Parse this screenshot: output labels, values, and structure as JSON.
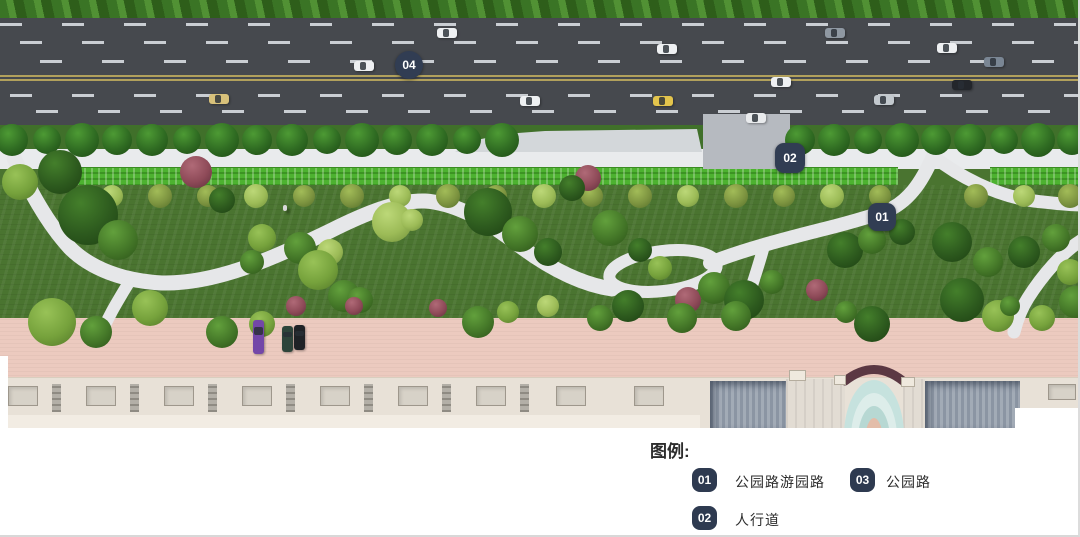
{
  "legend": {
    "title": "图例:",
    "badge_color": "#2e3a50",
    "items": [
      {
        "num": "01",
        "label": "公园路游园路"
      },
      {
        "num": "03",
        "label": "公园路"
      },
      {
        "num": "02",
        "label": "人行道"
      }
    ]
  },
  "markers": [
    {
      "label": "04",
      "meaning": "公园路"
    },
    {
      "label": "02",
      "meaning": "人行道"
    },
    {
      "label": "01",
      "meaning": "公园路游园路"
    }
  ],
  "scene": {
    "marker_bg": "#313d53",
    "road_color": "#46494e",
    "lane_dash_color": "#caced3",
    "center_line_color": "#b2a15c",
    "sidewalk_color": "#e9ebed",
    "hedge_color": "#4db230",
    "grass_color": "#4a7430",
    "path_color": "#e6e7e9",
    "promenade_color": "#eccabf",
    "building_color": "#e8e1d7",
    "pool_colors": [
      "#c6e2de",
      "#ddedea",
      "#b7d8d3",
      "#e3bda9"
    ],
    "tree_types": {
      "dk": {
        "b": "#2d5a1e",
        "l": "#447f2b",
        "d": "#1d3f12"
      },
      "md": {
        "b": "#447728",
        "l": "#62a03c",
        "d": "#2c5318"
      },
      "lt": {
        "b": "#76a23c",
        "l": "#98c257",
        "d": "#527728"
      },
      "pl": {
        "b": "#9cbb57",
        "l": "#bcd878",
        "d": "#6f8f3a"
      },
      "rd": {
        "b": "#8e4a58",
        "l": "#b06a77",
        "d": "#5f2f3c"
      },
      "ol": {
        "b": "#7d9440",
        "l": "#a2bc58",
        "d": "#55702a"
      },
      "st": {
        "b": "#2f6b22",
        "l": "#4d9a34",
        "d": "#1d4a14"
      }
    },
    "street_trees": {
      "y": 140,
      "xs": [
        12,
        47,
        82,
        117,
        152,
        187,
        222,
        257,
        292,
        327,
        362,
        397,
        432,
        467,
        502,
        800,
        834,
        868,
        902,
        936,
        970,
        1004,
        1038,
        1072
      ]
    },
    "olive_trees": {
      "y": 196,
      "xs": [
        112,
        160,
        208,
        256,
        304,
        352,
        400,
        448,
        496,
        544,
        592,
        640,
        688,
        736,
        784,
        832,
        880,
        976,
        1024,
        1070
      ]
    },
    "park_trees": [
      [
        20,
        182,
        18,
        "lt"
      ],
      [
        60,
        172,
        22,
        "dk"
      ],
      [
        88,
        215,
        30,
        "dk"
      ],
      [
        118,
        240,
        20,
        "md"
      ],
      [
        196,
        172,
        16,
        "rd"
      ],
      [
        222,
        200,
        13,
        "dk"
      ],
      [
        588,
        178,
        13,
        "rd"
      ],
      [
        572,
        188,
        13,
        "dk"
      ],
      [
        262,
        238,
        14,
        "lt"
      ],
      [
        300,
        248,
        16,
        "md"
      ],
      [
        330,
        252,
        13,
        "pl"
      ],
      [
        252,
        262,
        12,
        "md"
      ],
      [
        318,
        270,
        20,
        "lt"
      ],
      [
        344,
        296,
        16,
        "md"
      ],
      [
        296,
        306,
        10,
        "rd"
      ],
      [
        360,
        300,
        13,
        "md"
      ],
      [
        392,
        222,
        20,
        "pl"
      ],
      [
        412,
        220,
        11,
        "pl"
      ],
      [
        488,
        212,
        24,
        "dk"
      ],
      [
        520,
        234,
        18,
        "md"
      ],
      [
        548,
        252,
        14,
        "dk"
      ],
      [
        610,
        228,
        18,
        "md"
      ],
      [
        640,
        250,
        12,
        "dk"
      ],
      [
        660,
        268,
        12,
        "lt"
      ],
      [
        628,
        306,
        16,
        "dk"
      ],
      [
        688,
        300,
        13,
        "rd"
      ],
      [
        714,
        288,
        16,
        "md"
      ],
      [
        744,
        300,
        20,
        "dk"
      ],
      [
        772,
        282,
        12,
        "md"
      ],
      [
        817,
        290,
        11,
        "rd"
      ],
      [
        845,
        250,
        18,
        "dk"
      ],
      [
        872,
        240,
        14,
        "md"
      ],
      [
        902,
        232,
        13,
        "dk"
      ],
      [
        952,
        242,
        20,
        "dk"
      ],
      [
        988,
        262,
        15,
        "md"
      ],
      [
        1024,
        252,
        16,
        "dk"
      ],
      [
        1056,
        238,
        14,
        "md"
      ],
      [
        1070,
        272,
        13,
        "lt"
      ],
      [
        962,
        300,
        22,
        "dk"
      ],
      [
        998,
        316,
        16,
        "lt"
      ],
      [
        1075,
        302,
        16,
        "md"
      ],
      [
        150,
        308,
        18,
        "lt"
      ],
      [
        52,
        322,
        24,
        "lt"
      ],
      [
        96,
        332,
        16,
        "md"
      ],
      [
        222,
        332,
        16,
        "md"
      ],
      [
        262,
        324,
        13,
        "lt"
      ],
      [
        354,
        306,
        9,
        "rd"
      ],
      [
        438,
        308,
        9,
        "rd"
      ],
      [
        478,
        322,
        16,
        "md"
      ],
      [
        508,
        312,
        11,
        "lt"
      ],
      [
        548,
        306,
        11,
        "pl"
      ],
      [
        600,
        318,
        13,
        "md"
      ],
      [
        682,
        318,
        15,
        "md"
      ],
      [
        736,
        316,
        15,
        "md"
      ],
      [
        872,
        324,
        18,
        "dk"
      ],
      [
        846,
        312,
        11,
        "md"
      ],
      [
        1042,
        318,
        13,
        "lt"
      ],
      [
        1010,
        306,
        10,
        "md"
      ]
    ],
    "cars": [
      {
        "x": 447,
        "y": 33,
        "c": "#eef0f2"
      },
      {
        "x": 667,
        "y": 49,
        "c": "#eef0f2"
      },
      {
        "x": 835,
        "y": 33,
        "c": "#8f98a2"
      },
      {
        "x": 947,
        "y": 48,
        "c": "#eef0f2"
      },
      {
        "x": 994,
        "y": 62,
        "c": "#7a8694"
      },
      {
        "x": 364,
        "y": 66,
        "c": "#eef0f2"
      },
      {
        "x": 219,
        "y": 99,
        "c": "#d8c17a"
      },
      {
        "x": 530,
        "y": 101,
        "c": "#eef0f2"
      },
      {
        "x": 663,
        "y": 101,
        "c": "#e3c44c"
      },
      {
        "x": 781,
        "y": 82,
        "c": "#eef0f2"
      },
      {
        "x": 962,
        "y": 85,
        "c": "#23262b"
      },
      {
        "x": 884,
        "y": 100,
        "c": "#c3c9ce"
      },
      {
        "x": 756,
        "y": 118,
        "c": "#e9ebed"
      }
    ],
    "parked_cars": [
      {
        "x": 258,
        "y": 320,
        "h": 34,
        "c": "#7347a8"
      },
      {
        "x": 287,
        "y": 326,
        "h": 26,
        "c": "#2e443a"
      },
      {
        "x": 299,
        "y": 325,
        "h": 25,
        "c": "#1f2226"
      }
    ],
    "pedestrian": {
      "x": 283,
      "y": 205
    },
    "roof_units": {
      "y": 386,
      "w": 30,
      "h": 20,
      "xs": [
        8,
        86,
        164,
        242,
        320,
        398,
        476,
        556,
        634
      ]
    },
    "roof_strips": {
      "y": 384,
      "w": 9,
      "h": 28,
      "xs": [
        52,
        130,
        208,
        286,
        364,
        442,
        520
      ]
    },
    "far_right_unit": {
      "x": 1048,
      "y": 384,
      "w": 28,
      "h": 16
    },
    "parapets": [
      [
        789,
        370,
        17,
        11
      ],
      [
        834,
        375,
        12,
        10
      ],
      [
        901,
        377,
        14,
        10
      ]
    ]
  }
}
